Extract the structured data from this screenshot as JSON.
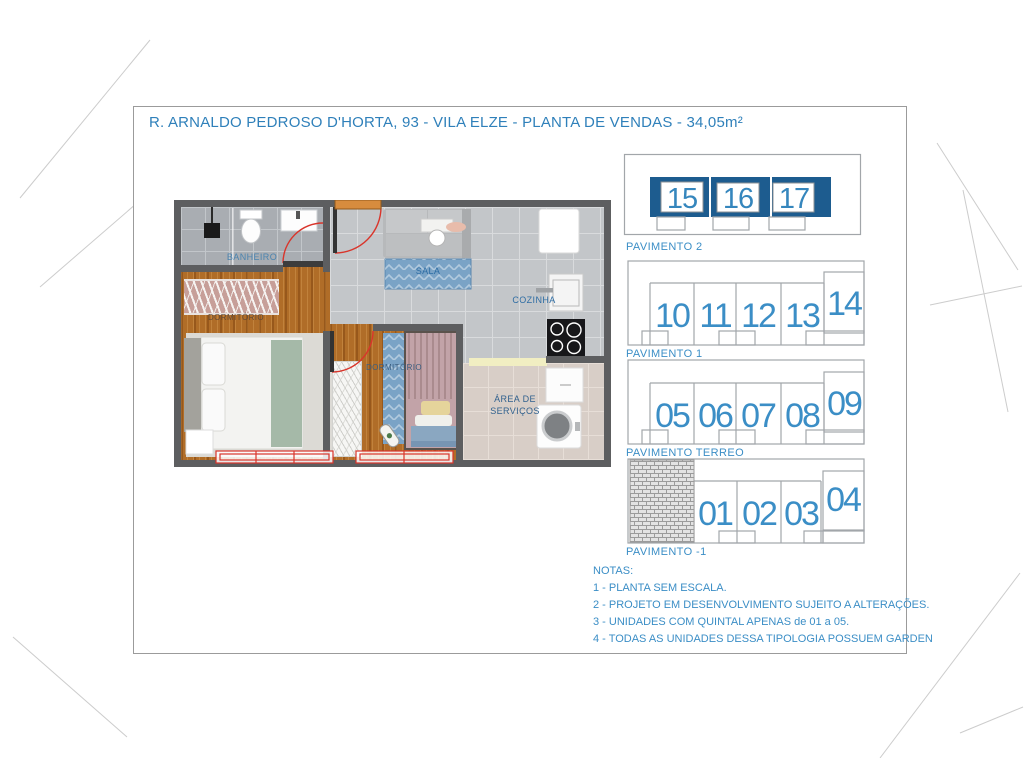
{
  "title": "R. ARNALDO PEDROSO D'HORTA, 93 - VILA ELZE - PLANTA DE VENDAS - 34,05m²",
  "plan": {
    "labels": {
      "banheiro": "BANHEIRO",
      "dormitorio1": "DORMITÓRIO",
      "sala": "SALA",
      "cozinha": "COZINHA",
      "dormitorio2": "DORMITÓRIO",
      "area_servicos_1": "ÁREA DE",
      "area_servicos_2": "SERVIÇOS"
    }
  },
  "building": {
    "floors": [
      {
        "label": "PAVIMENTO 2",
        "highlighted": true,
        "units": [
          "15",
          "16",
          "17"
        ]
      },
      {
        "label": "PAVIMENTO 1",
        "highlighted": false,
        "units": [
          "10",
          "11",
          "12",
          "13",
          "14"
        ]
      },
      {
        "label": "PAVIMENTO TERREO",
        "highlighted": false,
        "units": [
          "05",
          "06",
          "07",
          "08",
          "09"
        ]
      },
      {
        "label": "PAVIMENTO -1",
        "highlighted": false,
        "units": [
          "01",
          "02",
          "03",
          "04"
        ]
      }
    ]
  },
  "notes": {
    "heading": "NOTAS:",
    "items": [
      "1 - PLANTA SEM ESCALA.",
      "2 - PROJETO EM DESENVOLVIMENTO SUJEITO A ALTERAÇÕES.",
      "3 - UNIDADES COM QUINTAL APENAS de 01 a 05.",
      "4 - TODAS AS UNIDADES DESSA TIPOLOGIA POSSUEM GARDEN"
    ]
  },
  "colors": {
    "accent_blue": "#3b8ec6",
    "title_blue": "#2f80ba",
    "highlight_fill": "#1d5c8f",
    "outline_gray": "#a2a6aa",
    "window_red": "#d9352b",
    "wall_gray": "#5d5e60",
    "wood": "#b06d28"
  }
}
